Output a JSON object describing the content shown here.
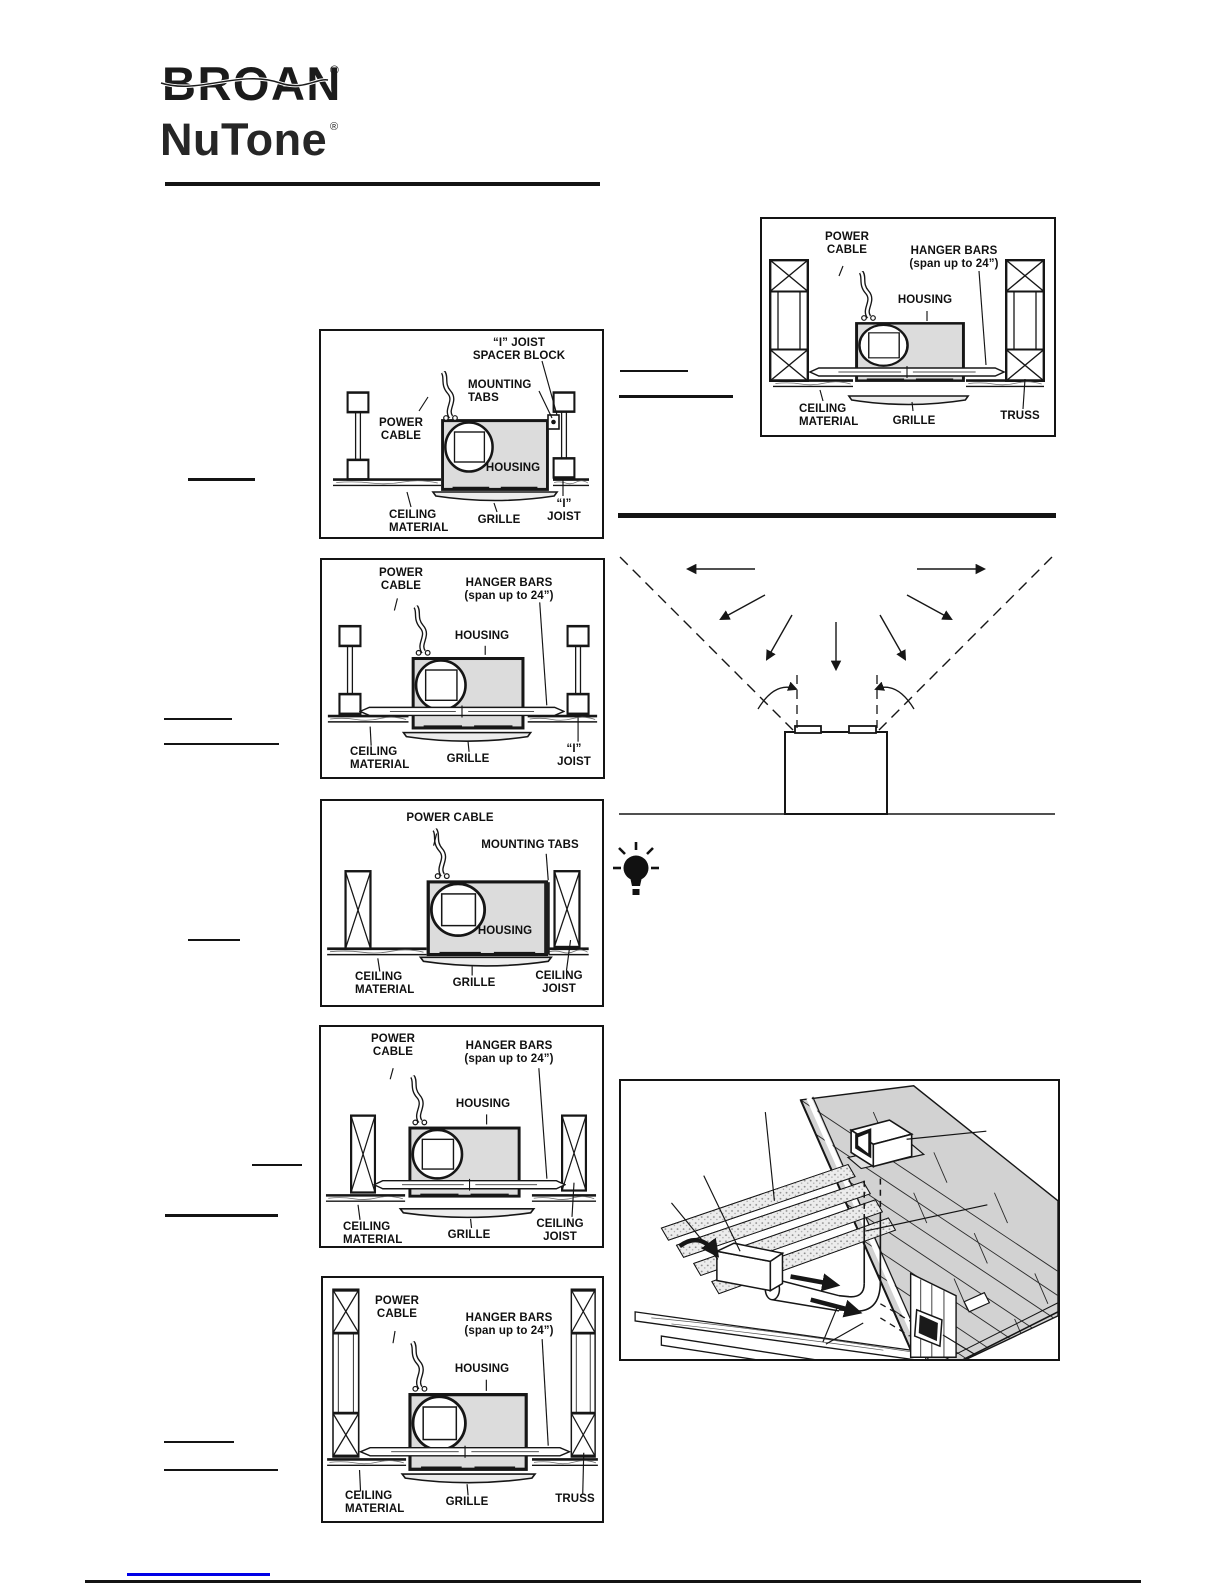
{
  "brand": {
    "line1": "BROAN",
    "line2": "NuTone",
    "registered": "®"
  },
  "figures": {
    "top_truss": {
      "power": "POWER\nCABLE",
      "hanger": "HANGER BARS\n(span up to 24”)",
      "housing": "HOUSING",
      "ceiling": "CEILING\nMATERIAL",
      "grille": "GRILLE",
      "support": "TRUSS"
    },
    "ijoist_tabs": {
      "spacer": "“I” JOIST\nSPACER BLOCK",
      "tabs": "MOUNTING\nTABS",
      "power": "POWER\nCABLE",
      "housing": "HOUSING",
      "ceiling": "CEILING\nMATERIAL",
      "grille": "GRILLE",
      "support": "“I”\nJOIST"
    },
    "ijoist_hanger": {
      "power": "POWER\nCABLE",
      "hanger": "HANGER BARS\n(span up to 24”)",
      "housing": "HOUSING",
      "ceiling": "CEILING\nMATERIAL",
      "grille": "GRILLE",
      "support": "“I”\nJOIST"
    },
    "cjoist_tabs": {
      "power": "POWER CABLE",
      "tabs": "MOUNTING TABS",
      "housing": "HOUSING",
      "ceiling": "CEILING\nMATERIAL",
      "grille": "GRILLE",
      "support": "CEILING\nJOIST"
    },
    "cjoist_hanger": {
      "power": "POWER\nCABLE",
      "hanger": "HANGER BARS\n(span up to 24”)",
      "housing": "HOUSING",
      "ceiling": "CEILING\nMATERIAL",
      "grille": "GRILLE",
      "support": "CEILING\nJOIST"
    },
    "truss_hanger": {
      "power": "POWER\nCABLE",
      "hanger": "HANGER BARS\n(span up to 24”)",
      "housing": "HOUSING",
      "ceiling": "CEILING\nMATERIAL",
      "grille": "GRILLE",
      "support": "TRUSS"
    }
  },
  "colors": {
    "ink": "#141414",
    "housing_fill": "#dcdcdc",
    "shingle_fill": "#d2d2d2",
    "link_blue": "#0000e6"
  }
}
